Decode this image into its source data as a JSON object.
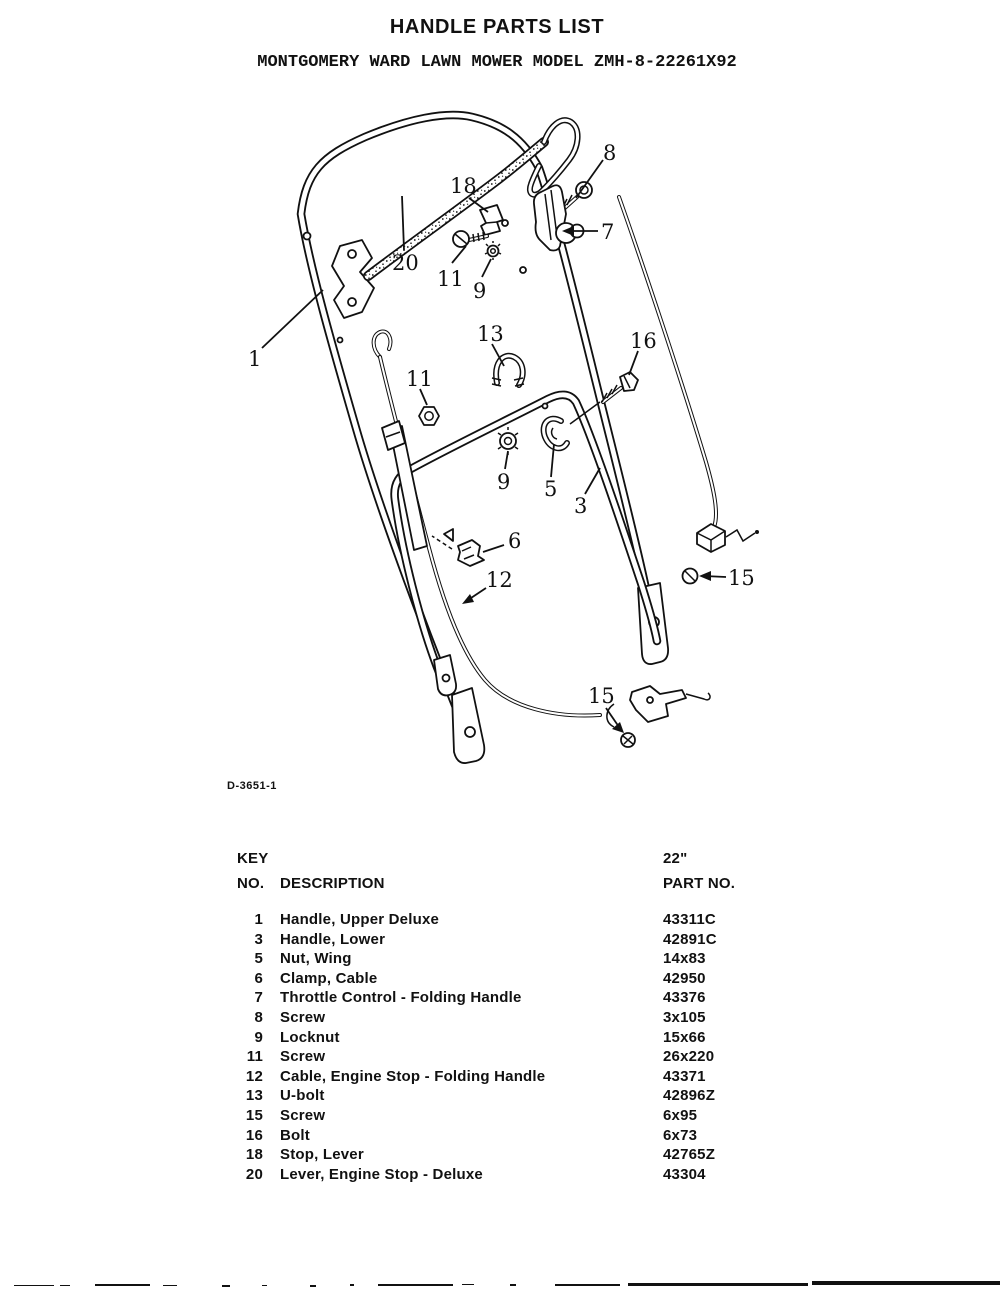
{
  "page": {
    "title": "HANDLE PARTS LIST",
    "subtitle": "MONTGOMERY WARD LAWN MOWER MODEL ZMH-8-22261X92",
    "drawing_number": "D-3651-1"
  },
  "diagram": {
    "callouts": [
      {
        "id": "callout-8",
        "label": "8"
      },
      {
        "id": "callout-18",
        "label": "18"
      },
      {
        "id": "callout-7",
        "label": "7"
      },
      {
        "id": "callout-20",
        "label": "20"
      },
      {
        "id": "callout-11-upper",
        "label": "11"
      },
      {
        "id": "callout-9-upper",
        "label": "9"
      },
      {
        "id": "callout-1",
        "label": "1"
      },
      {
        "id": "callout-13",
        "label": "13"
      },
      {
        "id": "callout-16",
        "label": "16"
      },
      {
        "id": "callout-11-lower",
        "label": "11"
      },
      {
        "id": "callout-9-lower",
        "label": "9"
      },
      {
        "id": "callout-5",
        "label": "5"
      },
      {
        "id": "callout-3",
        "label": "3"
      },
      {
        "id": "callout-6",
        "label": "6"
      },
      {
        "id": "callout-12",
        "label": "12"
      },
      {
        "id": "callout-15-right",
        "label": "15"
      },
      {
        "id": "callout-15-bottom",
        "label": "15"
      }
    ]
  },
  "table": {
    "col1_header_line1": "KEY",
    "col1_header_line2": "NO.",
    "col2_header": "DESCRIPTION",
    "col3_header_line1": "22\"",
    "col3_header_line2": "PART NO.",
    "rows": [
      {
        "key": "1",
        "description": "Handle, Upper Deluxe",
        "part": "43311C"
      },
      {
        "key": "3",
        "description": "Handle, Lower",
        "part": "42891C"
      },
      {
        "key": "5",
        "description": "Nut, Wing",
        "part": "14x83"
      },
      {
        "key": "6",
        "description": "Clamp, Cable",
        "part": "42950"
      },
      {
        "key": "7",
        "description": "Throttle Control - Folding Handle",
        "part": "43376"
      },
      {
        "key": "8",
        "description": "Screw",
        "part": "3x105"
      },
      {
        "key": "9",
        "description": "Locknut",
        "part": "15x66"
      },
      {
        "key": "11",
        "description": "Screw",
        "part": "26x220"
      },
      {
        "key": "12",
        "description": "Cable, Engine Stop - Folding Handle",
        "part": "43371"
      },
      {
        "key": "13",
        "description": "U-bolt",
        "part": "42896Z"
      },
      {
        "key": "15",
        "description": "Screw",
        "part": "6x95"
      },
      {
        "key": "16",
        "description": "Bolt",
        "part": "6x73"
      },
      {
        "key": "18",
        "description": "Stop, Lever",
        "part": "42765Z"
      },
      {
        "key": "20",
        "description": "Lever, Engine Stop - Deluxe",
        "part": "43304"
      }
    ]
  }
}
